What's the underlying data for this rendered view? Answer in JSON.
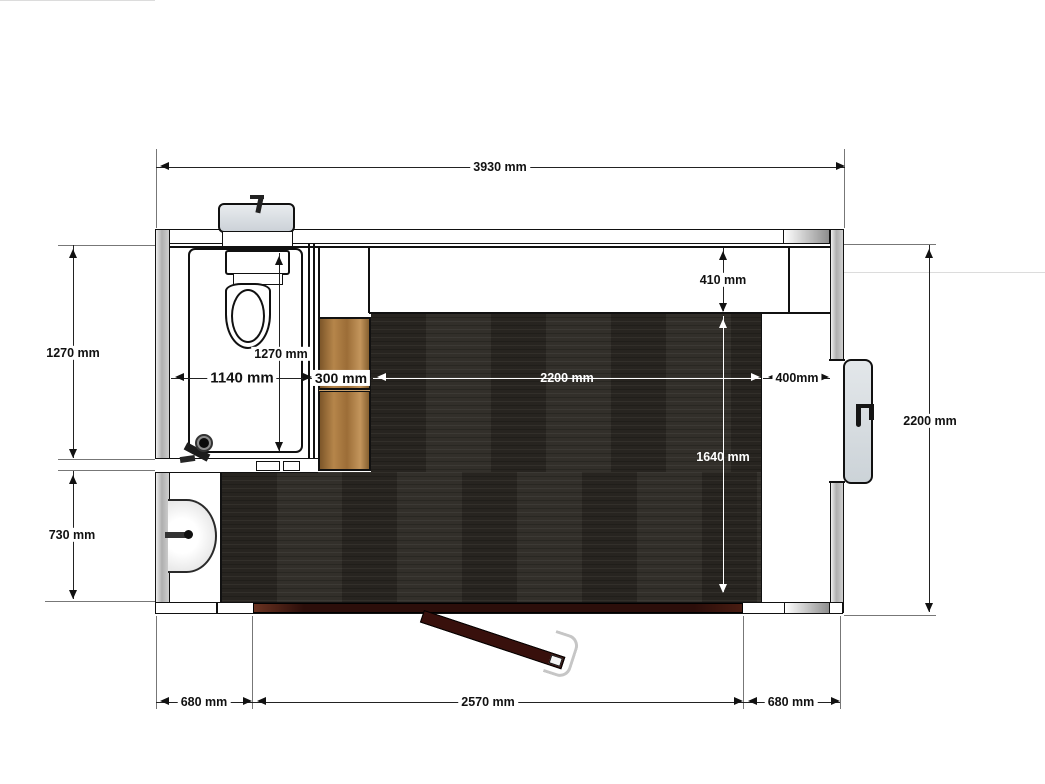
{
  "drawing": {
    "type": "floor-plan",
    "units": "mm",
    "view": "top-down plan of cabin with bathroom, cabinet, basin and entry door"
  },
  "dims": {
    "overall_width": "3930 mm",
    "left_upper": "1270 mm",
    "left_lower": "730 mm",
    "right_overall": "2200 mm",
    "bottom_left": "680 mm",
    "bottom_door": "2570 mm",
    "bottom_right": "680 mm",
    "bath_depth": "1270 mm",
    "bath_width": "1140 mm",
    "cabinet_width": "300 mm",
    "floor_width": "2200 mm",
    "ceiling_gap": "410 mm",
    "floor_depth": "1640 mm",
    "side_gap": "400mm"
  },
  "fixtures": [
    "toilet",
    "cistern",
    "wash-basin",
    "faucet",
    "floor-drain",
    "tall-cabinet",
    "entry-door",
    "door-sill",
    "side-hatch-window"
  ],
  "palette": {
    "wall_fill": "#b5b5b5",
    "dark_floor": "#2b2823",
    "cabinet_wood": "#a87c3f",
    "door_leaf": "#38100c",
    "door_sill": "#2c0e0a",
    "window_panel": "#dde2e6"
  }
}
